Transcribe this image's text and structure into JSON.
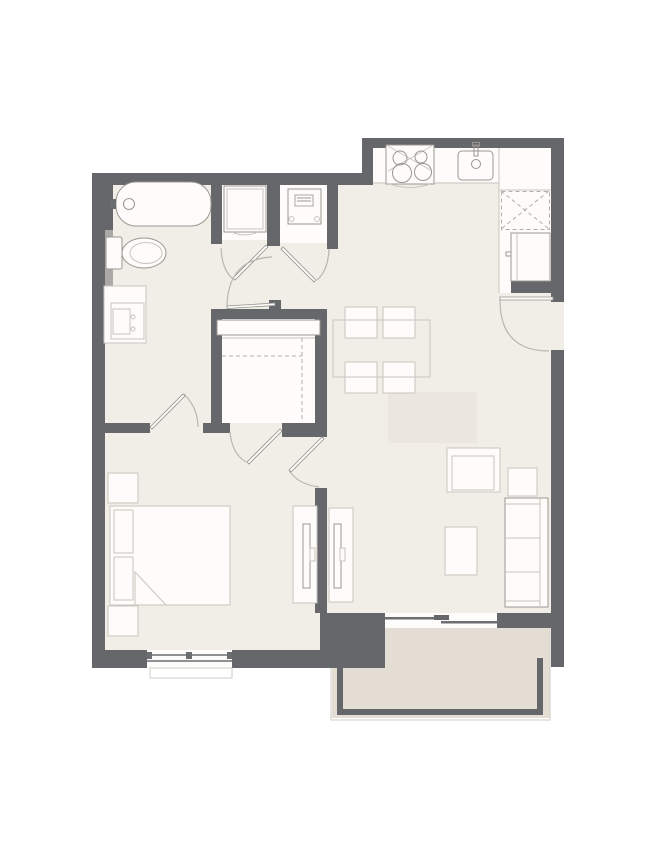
{
  "colors": {
    "outside": "#ffffff",
    "wall": "#65676a",
    "floor": "#f1ede7",
    "balcony": "#e3ddd3",
    "white": "#fdfcfa",
    "fixture_stroke": "#9a9792",
    "furniture_stroke": "#c9c5bf",
    "window_line": "#6b6d70",
    "door_arc": "#b9b6b0",
    "door_leaf": "#94928d",
    "rug": "#ebe7e0",
    "ledge": "#aaa9a6",
    "dashed": "#b2afa9",
    "sill": "#d0ccc6"
  },
  "fixtures": [
    "bathtub-icon",
    "toilet-icon",
    "vanity-sink-icon",
    "washer-unit-icon",
    "water-heater-icon",
    "stove-icon",
    "kitchen-sink-icon",
    "pantry-cabinet-icon",
    "refrigerator-icon",
    "closet-shelf-icon",
    "dining-table-icon",
    "dining-chair-icon",
    "bed-icon",
    "pillow-icon",
    "nightstand-icon",
    "tv-console-icon",
    "sofa-icon",
    "armchair-icon",
    "side-table-icon",
    "coffee-table-icon",
    "rug-icon",
    "window-icon",
    "sliding-door-icon",
    "door-swing-icon",
    "balcony-railing-icon",
    "entry-door-icon"
  ]
}
